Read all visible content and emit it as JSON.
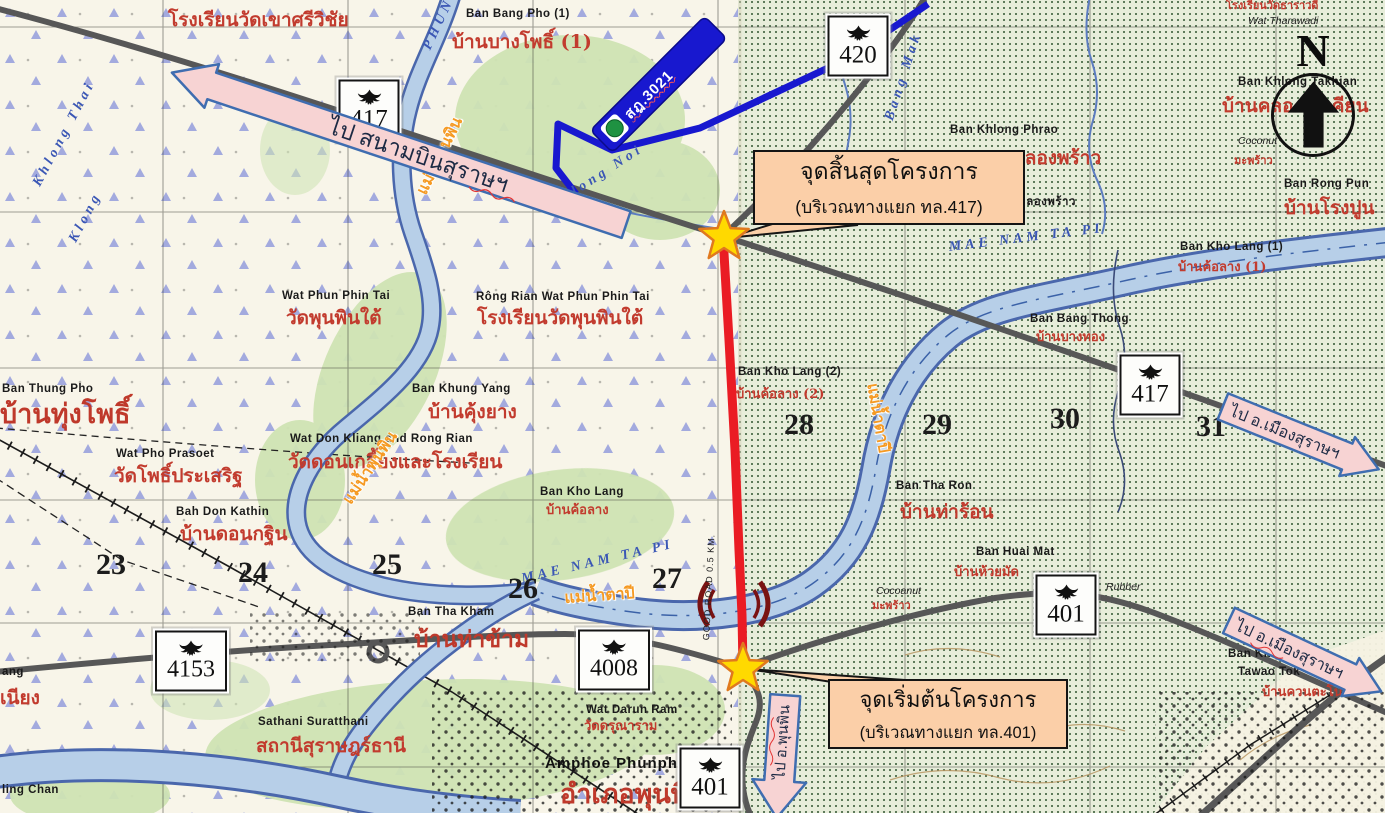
{
  "map": {
    "north_label": "N",
    "blue_banner": {
      "label": "สฎ.3021"
    },
    "callouts": {
      "end": {
        "title": "จุดสิ้นสุดโครงการ",
        "subtitle": "(บริเวณทางแยก ทล.417)"
      },
      "start": {
        "title": "จุดเริ่มต้นโครงการ",
        "subtitle": "(บริเวณทางแยก ทล.401)"
      }
    },
    "direction_arrows": [
      {
        "id": "airport",
        "label": "ไป สนามบินสุราษฯ",
        "direction": "left"
      },
      {
        "id": "mueang-1",
        "label": "ไป อ.เมืองสุราษฯ",
        "direction": "right"
      },
      {
        "id": "mueang-2",
        "label": "ไป อ.เมืองสุราษฯ",
        "direction": "right"
      },
      {
        "id": "phunphin",
        "label": "ไป อ.พุนพิน",
        "direction": "down"
      }
    ],
    "shields": [
      {
        "number": "417",
        "x": 369,
        "y": 110
      },
      {
        "number": "420",
        "x": 858,
        "y": 46
      },
      {
        "number": "417",
        "x": 1150,
        "y": 385
      },
      {
        "number": "401",
        "x": 1066,
        "y": 605
      },
      {
        "number": "4153",
        "x": 191,
        "y": 661
      },
      {
        "number": "4008",
        "x": 614,
        "y": 660
      },
      {
        "number": "401",
        "x": 710,
        "y": 778
      }
    ],
    "colors": {
      "project_route": "#ea1c24",
      "star": "#ffd900",
      "callout_bg": "#fbcfa8",
      "arrow_fill": "#f7d3d3",
      "arrow_border": "#3f6db0",
      "banner_blue": "#1818cf",
      "water": "#b7cfe8",
      "road_gray": "#575757"
    },
    "labels": [
      {
        "t": "โรงเรียนวัดเขาศรีวิชัย",
        "x": 168,
        "y": 10,
        "c": "red-lg"
      },
      {
        "t": "Ban Bang Pho (1)",
        "x": 466,
        "y": 8,
        "c": "en"
      },
      {
        "t": "บ้านบางโพธิ์ (1)",
        "x": 452,
        "y": 32,
        "c": "red-lg"
      },
      {
        "t": "PHUN",
        "x": 420,
        "y": 46,
        "c": "blue",
        "r": -65
      },
      {
        "t": "Khlong Thai",
        "x": 30,
        "y": 182,
        "c": "blue",
        "r": -62
      },
      {
        "t": "Klong",
        "x": 66,
        "y": 238,
        "c": "blue",
        "r": -62
      },
      {
        "t": "แม่น้ำพุนพิน",
        "x": 414,
        "y": 190,
        "c": "orange",
        "r": -64
      },
      {
        "t": "Khlong Noi",
        "x": 548,
        "y": 200,
        "c": "blue",
        "r": -33
      },
      {
        "t": "Bang Mak",
        "x": 882,
        "y": 118,
        "c": "blue",
        "r": -72
      },
      {
        "t": "Wat Phun Phin Tai",
        "x": 282,
        "y": 290,
        "c": "en"
      },
      {
        "t": "วัดพุนพินใต้",
        "x": 286,
        "y": 308,
        "c": "red-lg"
      },
      {
        "t": "Rông Rian Wat Phun Phin Tai",
        "x": 476,
        "y": 291,
        "c": "en"
      },
      {
        "t": "โรงเรียนวัดพุนพินใต้",
        "x": 477,
        "y": 308,
        "c": "red-lg"
      },
      {
        "t": "Ban Khung Yang",
        "x": 412,
        "y": 383,
        "c": "en"
      },
      {
        "t": "บ้านคุ้งยาง",
        "x": 428,
        "y": 402,
        "c": "red-lg"
      },
      {
        "t": "Wat Don Kliang and Rong Rian",
        "x": 290,
        "y": 433,
        "c": "en"
      },
      {
        "t": "วัดดอนเกลี้ยงและโรงเรียน",
        "x": 288,
        "y": 452,
        "c": "red-lg"
      },
      {
        "t": "แม่น้ำพุนพิน",
        "x": 340,
        "y": 498,
        "c": "orange",
        "r": -56
      },
      {
        "t": "Ban Thung Pho",
        "x": 2,
        "y": 383,
        "c": "en"
      },
      {
        "t": "บ้านทุ่งโพธิ์",
        "x": 0,
        "y": 400,
        "c": "red-xxl"
      },
      {
        "t": "Wat Pho Prasoet",
        "x": 116,
        "y": 448,
        "c": "en"
      },
      {
        "t": "วัดโพธิ์ประเสริฐ",
        "x": 114,
        "y": 466,
        "c": "red-lg"
      },
      {
        "t": "Bah Don Kathin",
        "x": 176,
        "y": 506,
        "c": "en"
      },
      {
        "t": "บ้านดอนกฐิน",
        "x": 180,
        "y": 524,
        "c": "red-lg"
      },
      {
        "t": "Ban Kho Lang",
        "x": 540,
        "y": 486,
        "c": "en"
      },
      {
        "t": "บ้านค้อลาง",
        "x": 546,
        "y": 504,
        "c": "red"
      },
      {
        "t": "MAE NAM TA PI",
        "x": 520,
        "y": 572,
        "c": "blue",
        "r": -13
      },
      {
        "t": "แม่น้ำตาปี",
        "x": 564,
        "y": 590,
        "c": "orange",
        "r": -4
      },
      {
        "t": "Ban Tha Kham",
        "x": 408,
        "y": 606,
        "c": "en"
      },
      {
        "t": "บ้านท่าข้าม",
        "x": 414,
        "y": 627,
        "c": "red-xl"
      },
      {
        "t": "Ban Kho Lang (2)",
        "x": 738,
        "y": 366,
        "c": "en"
      },
      {
        "t": "บ้านค้อลาง (2)",
        "x": 736,
        "y": 388,
        "c": "red"
      },
      {
        "t": "แม่น้ำตาปี",
        "x": 880,
        "y": 382,
        "c": "orange",
        "r": 80
      },
      {
        "t": "Ban Tha Ron",
        "x": 896,
        "y": 480,
        "c": "en"
      },
      {
        "t": "บ้านท่าร้อน",
        "x": 900,
        "y": 502,
        "c": "red-lg"
      },
      {
        "t": "Ban Huai Mat",
        "x": 976,
        "y": 546,
        "c": "en"
      },
      {
        "t": "บ้านห้วยมัด",
        "x": 954,
        "y": 566,
        "c": "red"
      },
      {
        "t": "Cocoanut",
        "x": 876,
        "y": 586,
        "c": "en-it"
      },
      {
        "t": "มะพร้าว",
        "x": 872,
        "y": 600,
        "c": "red-sm"
      },
      {
        "t": "Rubber",
        "x": 1106,
        "y": 582,
        "c": "en-it"
      },
      {
        "t": "Ban Khlong Phrao",
        "x": 950,
        "y": 124,
        "c": "en"
      },
      {
        "t": "คลองพร้าว",
        "x": 1012,
        "y": 148,
        "c": "red-lg"
      },
      {
        "t": "คลองพร้าว",
        "x": 1018,
        "y": 196,
        "c": "en"
      },
      {
        "t": "MAE NAM TA PI",
        "x": 948,
        "y": 240,
        "c": "blue",
        "r": -7
      },
      {
        "t": "Ban Bang Thong",
        "x": 1030,
        "y": 313,
        "c": "en"
      },
      {
        "t": "บ้านบางทอง",
        "x": 1036,
        "y": 331,
        "c": "red"
      },
      {
        "t": "Ban Kho Lang (1)",
        "x": 1180,
        "y": 241,
        "c": "en"
      },
      {
        "t": "บ้านค้อลาง (1)",
        "x": 1178,
        "y": 261,
        "c": "red"
      },
      {
        "t": "Coconut",
        "x": 1238,
        "y": 136,
        "c": "en-it"
      },
      {
        "t": "มะพร้าว",
        "x": 1234,
        "y": 155,
        "c": "red-sm"
      },
      {
        "t": "Ban Rong Pun",
        "x": 1284,
        "y": 178,
        "c": "en"
      },
      {
        "t": "บ้านโรงปูน",
        "x": 1284,
        "y": 198,
        "c": "red-lg"
      },
      {
        "t": "Wat Tharawadi",
        "x": 1248,
        "y": 16,
        "c": "en-it"
      },
      {
        "t": "โรงเรียนวัดธาราวดี",
        "x": 1226,
        "y": 0,
        "c": "red-sm"
      },
      {
        "t": "Ban Khlong Takhian",
        "x": 1238,
        "y": 76,
        "c": "en"
      },
      {
        "t": "บ้านคลองตะเคียน",
        "x": 1222,
        "y": 96,
        "c": "red-lg"
      },
      {
        "t": "Sathani Suratthani",
        "x": 258,
        "y": 716,
        "c": "en"
      },
      {
        "t": "สถานีสุราษฎร์ธานี",
        "x": 256,
        "y": 736,
        "c": "red-lg"
      },
      {
        "t": "Wat Darun Ram",
        "x": 586,
        "y": 704,
        "c": "en"
      },
      {
        "t": "วัดดรุณาราม",
        "x": 584,
        "y": 720,
        "c": "red"
      },
      {
        "t": "Amphoe Phunphin",
        "x": 545,
        "y": 756,
        "c": "en-lg"
      },
      {
        "t": "อำเภอพุนพิน",
        "x": 560,
        "y": 780,
        "c": "red-xxl"
      },
      {
        "t": "ling Chan",
        "x": 2,
        "y": 784,
        "c": "en"
      },
      {
        "t": "ang",
        "x": 2,
        "y": 666,
        "c": "en"
      },
      {
        "t": "เนียง",
        "x": 0,
        "y": 688,
        "c": "red-lg"
      },
      {
        "t": "Ban Khuan",
        "x": 1228,
        "y": 648,
        "c": "en"
      },
      {
        "t": "Tawao Tok",
        "x": 1238,
        "y": 666,
        "c": "en"
      },
      {
        "t": "บ้านควนตะโนด",
        "x": 1262,
        "y": 686,
        "c": "red"
      },
      {
        "t": "GOOD ROAD 0.5 KM.",
        "x": 702,
        "y": 640,
        "c": "tiny",
        "r": -87
      },
      {
        "t": "23",
        "x": 96,
        "y": 548,
        "c": "num"
      },
      {
        "t": "24",
        "x": 238,
        "y": 556,
        "c": "num"
      },
      {
        "t": "25",
        "x": 372,
        "y": 548,
        "c": "num"
      },
      {
        "t": "26",
        "x": 508,
        "y": 572,
        "c": "num"
      },
      {
        "t": "27",
        "x": 652,
        "y": 562,
        "c": "num"
      },
      {
        "t": "28",
        "x": 784,
        "y": 408,
        "c": "num"
      },
      {
        "t": "29",
        "x": 922,
        "y": 408,
        "c": "num"
      },
      {
        "t": "30",
        "x": 1050,
        "y": 402,
        "c": "num"
      },
      {
        "t": "31",
        "x": 1196,
        "y": 410,
        "c": "num"
      }
    ]
  }
}
